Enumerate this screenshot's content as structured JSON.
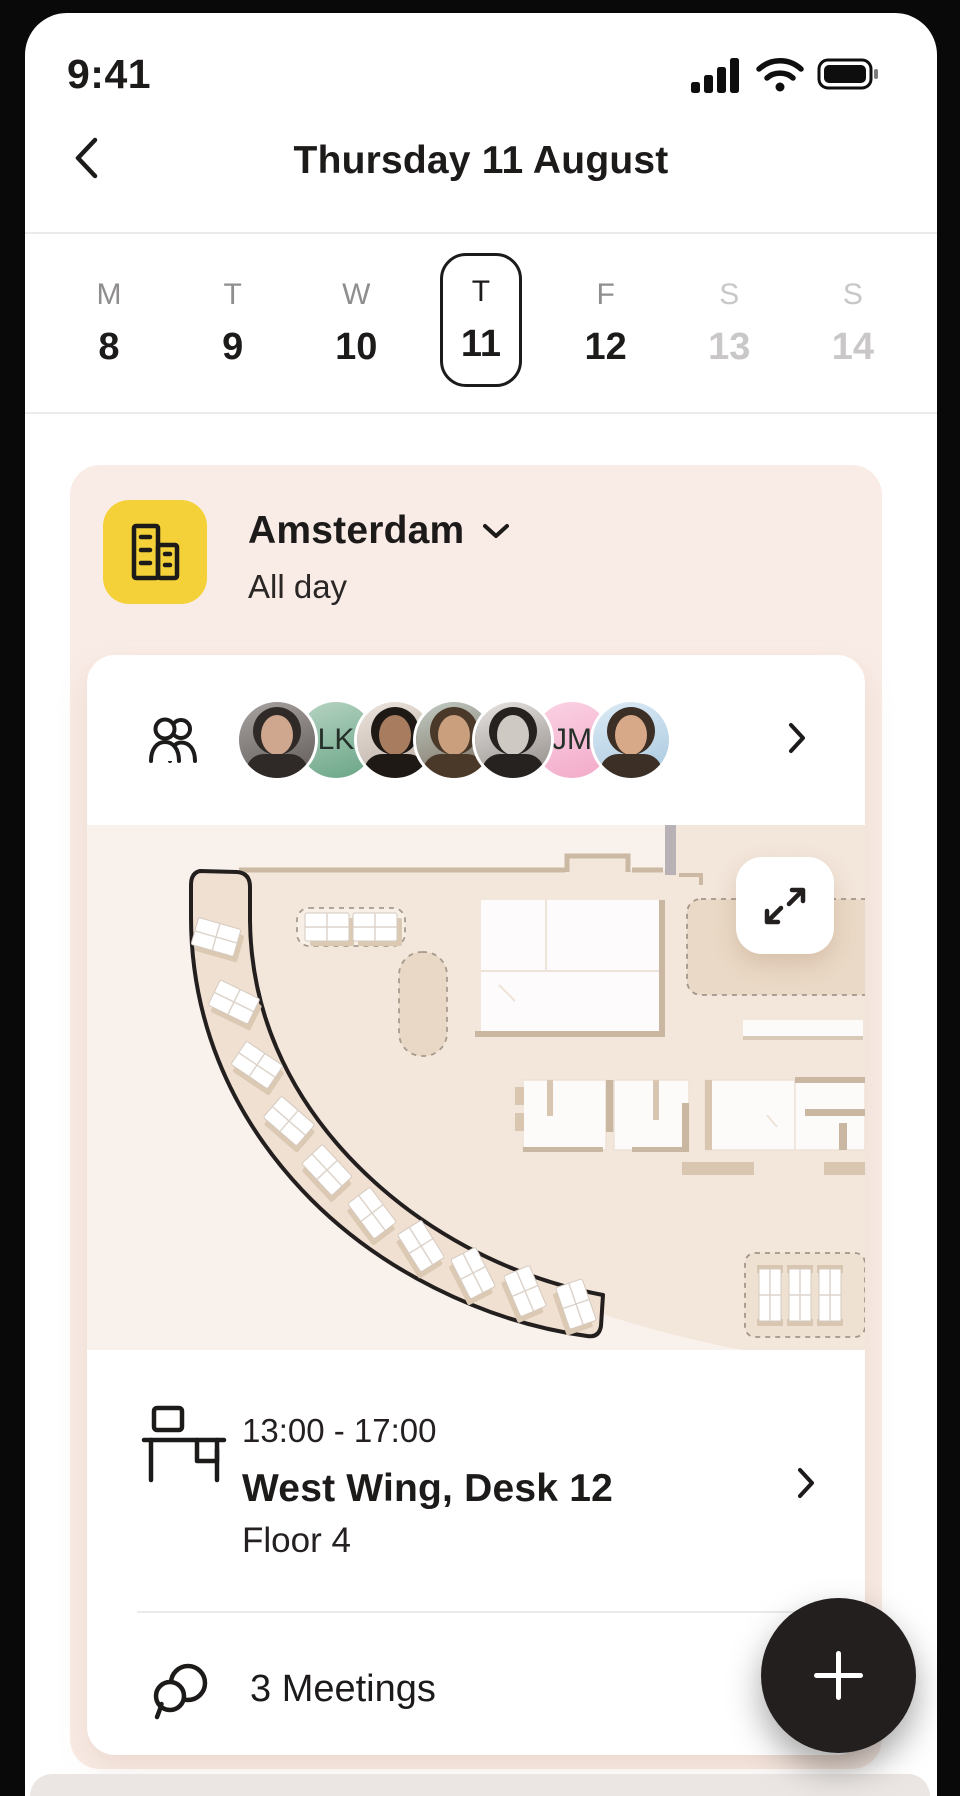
{
  "status_bar": {
    "time": "9:41",
    "icons": [
      "signal-icon",
      "wifi-icon",
      "battery-icon"
    ]
  },
  "header": {
    "back_icon": "chevron-left-icon",
    "title": "Thursday 11 August"
  },
  "week_strip": {
    "days": [
      {
        "letter": "M",
        "date": "8",
        "state": "default"
      },
      {
        "letter": "T",
        "date": "9",
        "state": "default"
      },
      {
        "letter": "W",
        "date": "10",
        "state": "default"
      },
      {
        "letter": "T",
        "date": "11",
        "state": "selected"
      },
      {
        "letter": "F",
        "date": "12",
        "state": "default"
      },
      {
        "letter": "S",
        "date": "13",
        "state": "muted"
      },
      {
        "letter": "S",
        "date": "14",
        "state": "muted"
      }
    ]
  },
  "event_card": {
    "location": "Amsterdam",
    "duration": "All day",
    "location_icon": "office-building-icon",
    "dropdown_icon": "chevron-down-icon",
    "colors": {
      "icon_bg": "#f5d139",
      "card_bg": "#f9ece6"
    }
  },
  "attendees": {
    "group_icon": "people-icon",
    "chevron_icon": "chevron-right-icon",
    "avatars": [
      {
        "kind": "photo",
        "label": "",
        "bg1": "#a8a2a0",
        "bg2": "#5f5a58",
        "skin": "#cfa78e",
        "hair": "#2f2a27"
      },
      {
        "kind": "initials",
        "label": "LK",
        "bg1": "#b7d4c2",
        "bg2": "#68a486"
      },
      {
        "kind": "photo",
        "label": "",
        "bg1": "#ece4dd",
        "bg2": "#b9aba1",
        "skin": "#a87c5f",
        "hair": "#1f1915"
      },
      {
        "kind": "photo",
        "label": "",
        "bg1": "#c2cdc5",
        "bg2": "#79695a",
        "skin": "#c99f7d",
        "hair": "#4a3829"
      },
      {
        "kind": "photo",
        "label": "",
        "bg1": "#e8e4e1",
        "bg2": "#8f8a86",
        "skin": "#cfc9c4",
        "hair": "#262220"
      },
      {
        "kind": "initials",
        "label": "JM",
        "bg1": "#fbd3e4",
        "bg2": "#f2a9c8"
      },
      {
        "kind": "photo",
        "label": "",
        "bg1": "#dcebf6",
        "bg2": "#a9c8de",
        "skin": "#d8a988",
        "hair": "#3c2f26"
      }
    ]
  },
  "floor_map": {
    "expand_icon": "expand-icon",
    "colors": {
      "floor": "#f3e6da",
      "walls": "#cbb9a4",
      "highlight_outline": "#241f1f"
    }
  },
  "desk_booking": {
    "icon": "desk-icon",
    "time_range": "13:00 - 17:00",
    "location": "West Wing, Desk 12",
    "floor": "Floor 4",
    "chevron_icon": "chevron-right-icon"
  },
  "meetings": {
    "icon": "chat-icon",
    "label": "3 Meetings"
  },
  "fab": {
    "icon": "plus-icon",
    "bg": "#241f1f"
  }
}
